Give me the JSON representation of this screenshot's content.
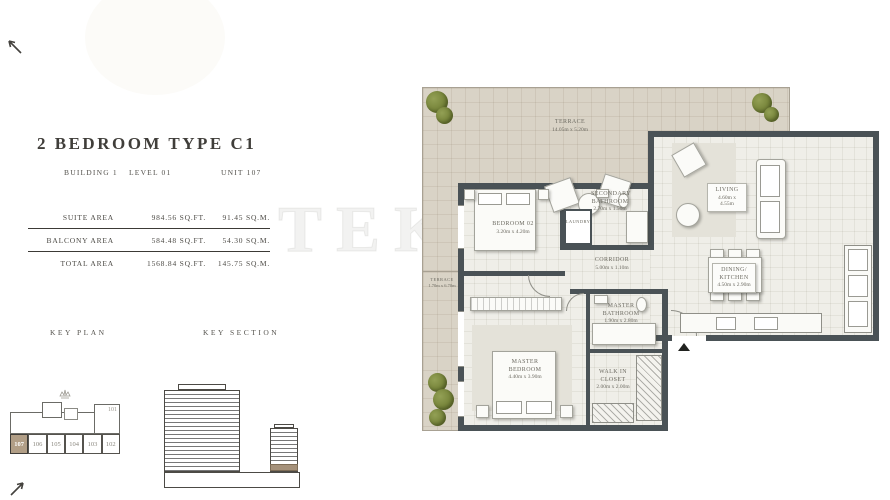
{
  "header": {
    "title": "2 BEDROOM TYPE C1",
    "building": "BUILDING 1",
    "level": "LEVEL 01",
    "unit": "UNIT 107"
  },
  "areas": {
    "rows": [
      {
        "label": "SUITE AREA",
        "sqft": "984.56 SQ.FT.",
        "sqm": "91.45 SQ.M."
      },
      {
        "label": "BALCONY AREA",
        "sqft": "584.48 SQ.FT.",
        "sqm": "54.30 SQ.M."
      },
      {
        "label": "TOTAL AREA",
        "sqft": "1568.84 SQ.FT.",
        "sqm": "145.75 SQ.M."
      }
    ]
  },
  "key_plan": {
    "title": "KEY PLAN",
    "upper_unit": "101",
    "units": [
      "107",
      "106",
      "105",
      "104",
      "103",
      "102"
    ],
    "highlighted_unit": "107"
  },
  "key_section": {
    "title": "KEY SECTION"
  },
  "watermark": "TEKCE",
  "plan": {
    "rooms": [
      {
        "name": "TERRACE",
        "dims": "14.05m x 5.20m"
      },
      {
        "name": "TERRACE",
        "dims": "1.70m x 6.70m"
      },
      {
        "name": "BEDROOM 02",
        "dims": "3.20m x 4.20m"
      },
      {
        "name": "SECONDARY BATHROOM",
        "dims": "2.70m x 1.50m"
      },
      {
        "name": "LAUNDRY",
        "dims": ""
      },
      {
        "name": "CORRIDOR",
        "dims": "5.00m x 1.10m"
      },
      {
        "name": "LIVING",
        "dims": "4.60m x 4.55m"
      },
      {
        "name": "DINING/ KITCHEN",
        "dims": "4.50m x 2.90m"
      },
      {
        "name": "MASTER BEDROOM",
        "dims": "4.40m x 3.90m"
      },
      {
        "name": "MASTER BATHROOM",
        "dims": "1.90m x 2.80m"
      },
      {
        "name": "WALK IN CLOSET",
        "dims": "2.00m x 2.00m"
      }
    ]
  },
  "colors": {
    "wall": "#4a5256",
    "terrace": "#d9d3c6",
    "highlight": "#b19e86",
    "section_band": "#a5917a"
  }
}
